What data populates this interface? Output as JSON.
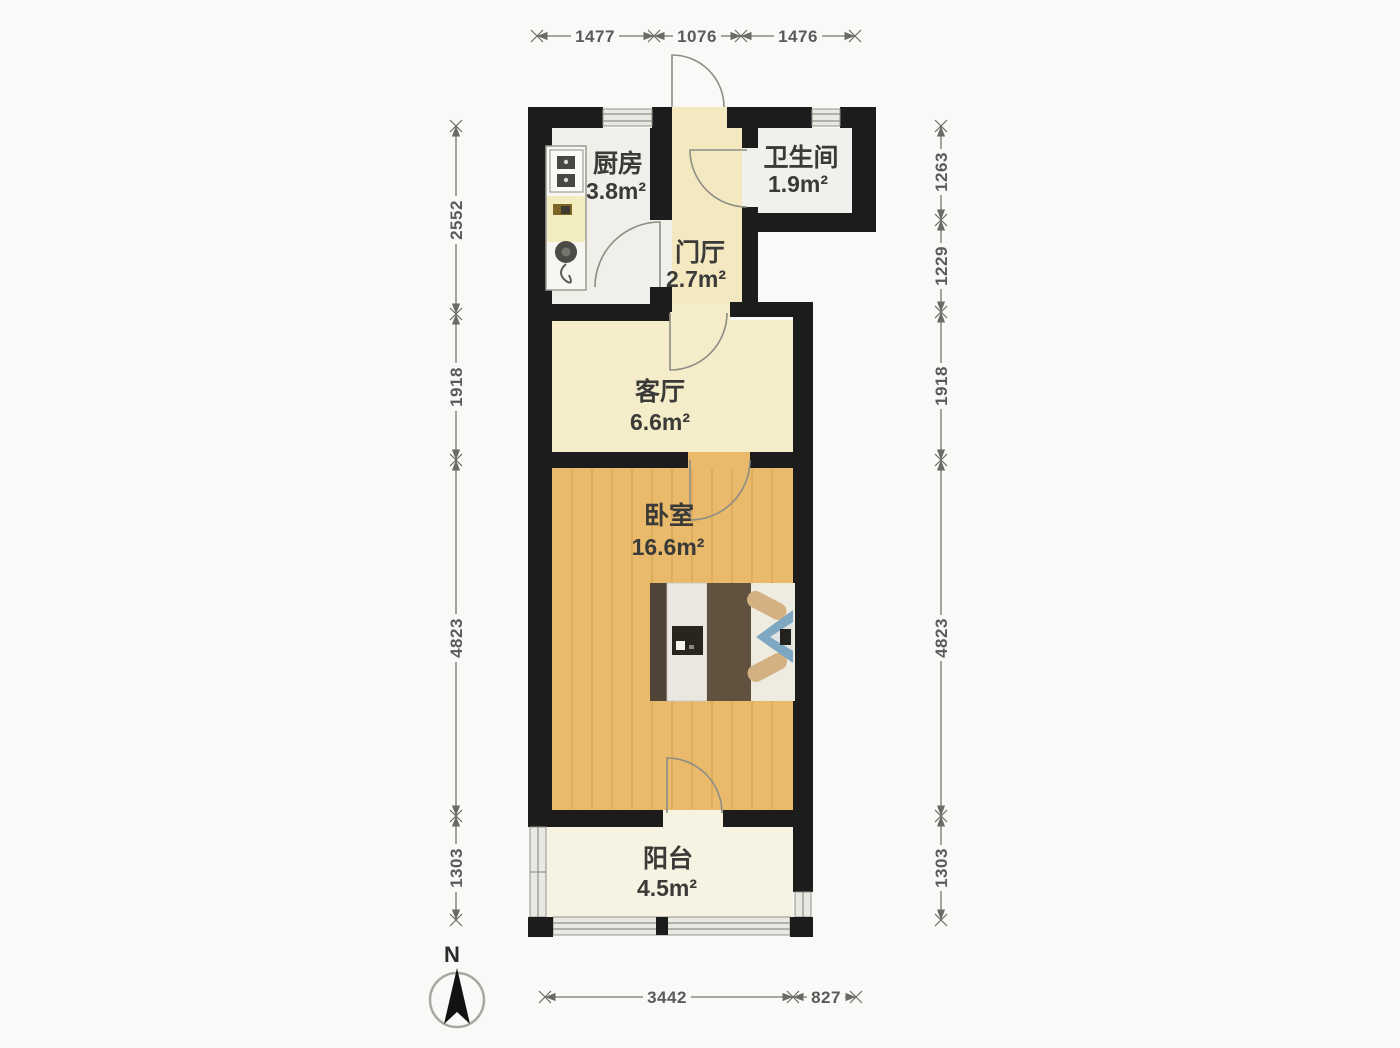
{
  "rooms": {
    "kitchen": {
      "name": "厨房",
      "area": "3.8m²"
    },
    "bathroom": {
      "name": "卫生间",
      "area": "1.9m²"
    },
    "hall": {
      "name": "门厅",
      "area": "2.7m²"
    },
    "living": {
      "name": "客厅",
      "area": "6.6m²"
    },
    "bedroom": {
      "name": "卧室",
      "area": "16.6m²"
    },
    "balcony": {
      "name": "阳台",
      "area": "4.5m²"
    }
  },
  "dimensions": {
    "top": [
      "1477",
      "1076",
      "1476"
    ],
    "left": [
      "2552",
      "1918",
      "4823",
      "1303"
    ],
    "right": [
      "1263",
      "1229",
      "1918",
      "4823",
      "1303"
    ],
    "bottom": [
      "3442",
      "827"
    ]
  },
  "compass": {
    "north_label": "N"
  },
  "colors": {
    "bg": "#faf9f7",
    "wall": "#1c1c1c",
    "kitchenFloor": "#f0efe9",
    "bathFloor": "#f1f0ec",
    "hallFloor": "#f3e8c0",
    "livingFloor": "#f5edc9",
    "bedroomFloor": "#e9ba6c",
    "balconyFloor": "#f7f3e2",
    "bedBrown": "#60523f",
    "pillowTan": "#d3b183",
    "quiltBlue": "#7ea7c2"
  }
}
